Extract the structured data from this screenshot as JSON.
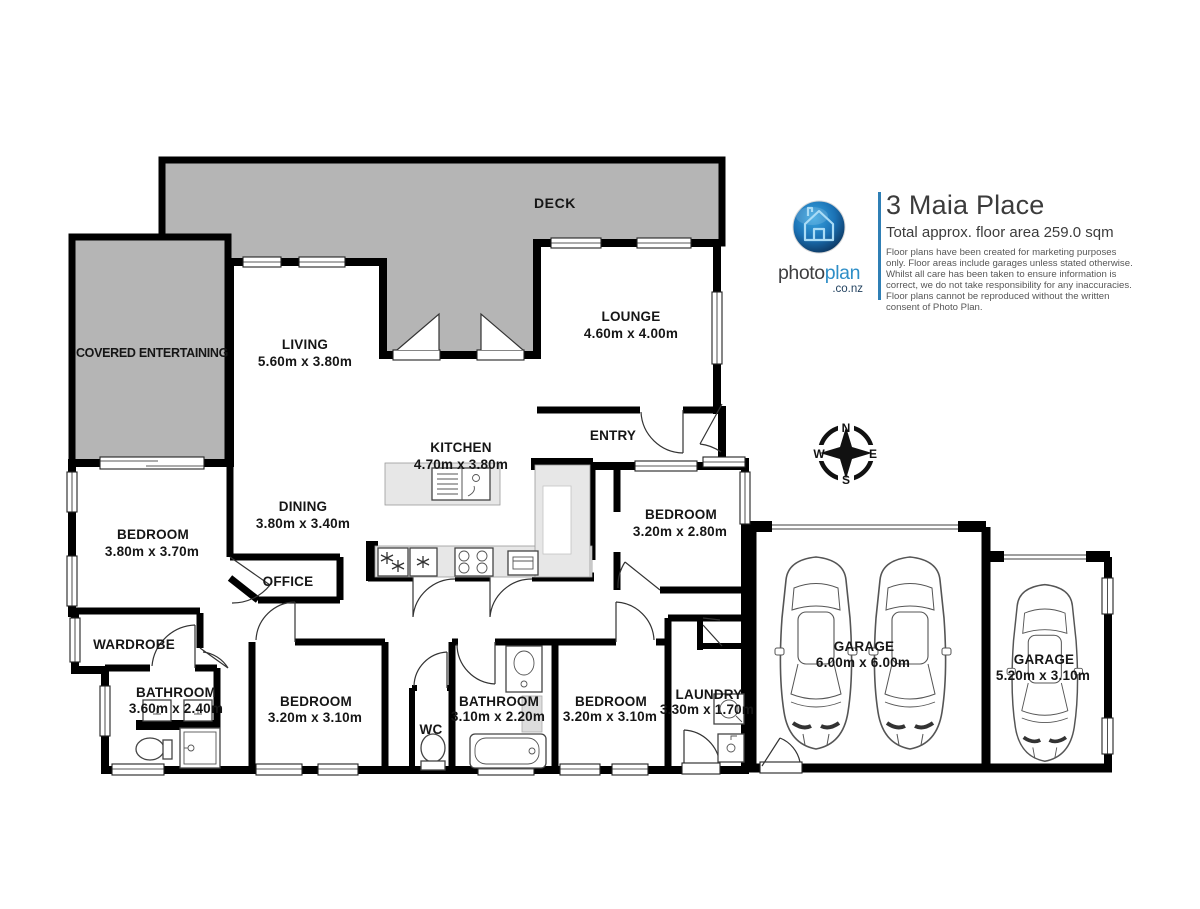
{
  "title_block": {
    "title": "3 Maia Place",
    "subtitle": "Total approx. floor area 259.0 sqm",
    "disclaimer": "Floor plans have been created for marketing purposes only. Floor areas include garages unless stated otherwise. Whilst all care has been taken to ensure information is correct, we do not take responsibility for any inaccuracies. Floor plans cannot be reproduced without the written consent of Photo Plan."
  },
  "logo": {
    "photo": "photo",
    "plan": "plan",
    "suffix": ".co.nz"
  },
  "compass": {
    "north": "N",
    "east": "E",
    "south": "S",
    "west": "W"
  },
  "colors": {
    "wall": "#000000",
    "deck_gray": "#b5b5b5",
    "counter_gray": "#e7e7e7",
    "logo_blue": "#2e8ec7",
    "logo_dark": "#0b3057"
  },
  "rooms": {
    "deck": {
      "label": "DECK"
    },
    "covered_entertaining": {
      "label": "COVERED ENTERTAINING"
    },
    "living": {
      "label": "LIVING",
      "dims": "5.60m x 3.80m"
    },
    "lounge": {
      "label": "LOUNGE",
      "dims": "4.60m x 4.00m"
    },
    "entry": {
      "label": "ENTRY"
    },
    "kitchen": {
      "label": "KITCHEN",
      "dims": "4.70m x 3.80m"
    },
    "dining": {
      "label": "DINING",
      "dims": "3.80m x 3.40m"
    },
    "bedroom_master": {
      "label": "BEDROOM",
      "dims": "3.80m x 3.70m"
    },
    "bedroom_entry": {
      "label": "BEDROOM",
      "dims": "3.20m x 2.80m"
    },
    "office": {
      "label": "OFFICE"
    },
    "wardrobe": {
      "label": "WARDROBE"
    },
    "bathroom_ensuite": {
      "label": "BATHROOM",
      "dims": "3.60m x 2.40m"
    },
    "bedroom_2": {
      "label": "BEDROOM",
      "dims": "3.20m x 3.10m"
    },
    "wc": {
      "label": "WC"
    },
    "bathroom_main": {
      "label": "BATHROOM",
      "dims": "3.10m x 2.20m"
    },
    "bedroom_3": {
      "label": "BEDROOM",
      "dims": "3.20m x 3.10m"
    },
    "laundry": {
      "label": "LAUNDRY",
      "dims": "3.30m x 1.70m"
    },
    "garage_double": {
      "label": "GARAGE",
      "dims": "6.00m x 6.00m"
    },
    "garage_single": {
      "label": "GARAGE",
      "dims": "5.20m x 3.10m"
    }
  }
}
